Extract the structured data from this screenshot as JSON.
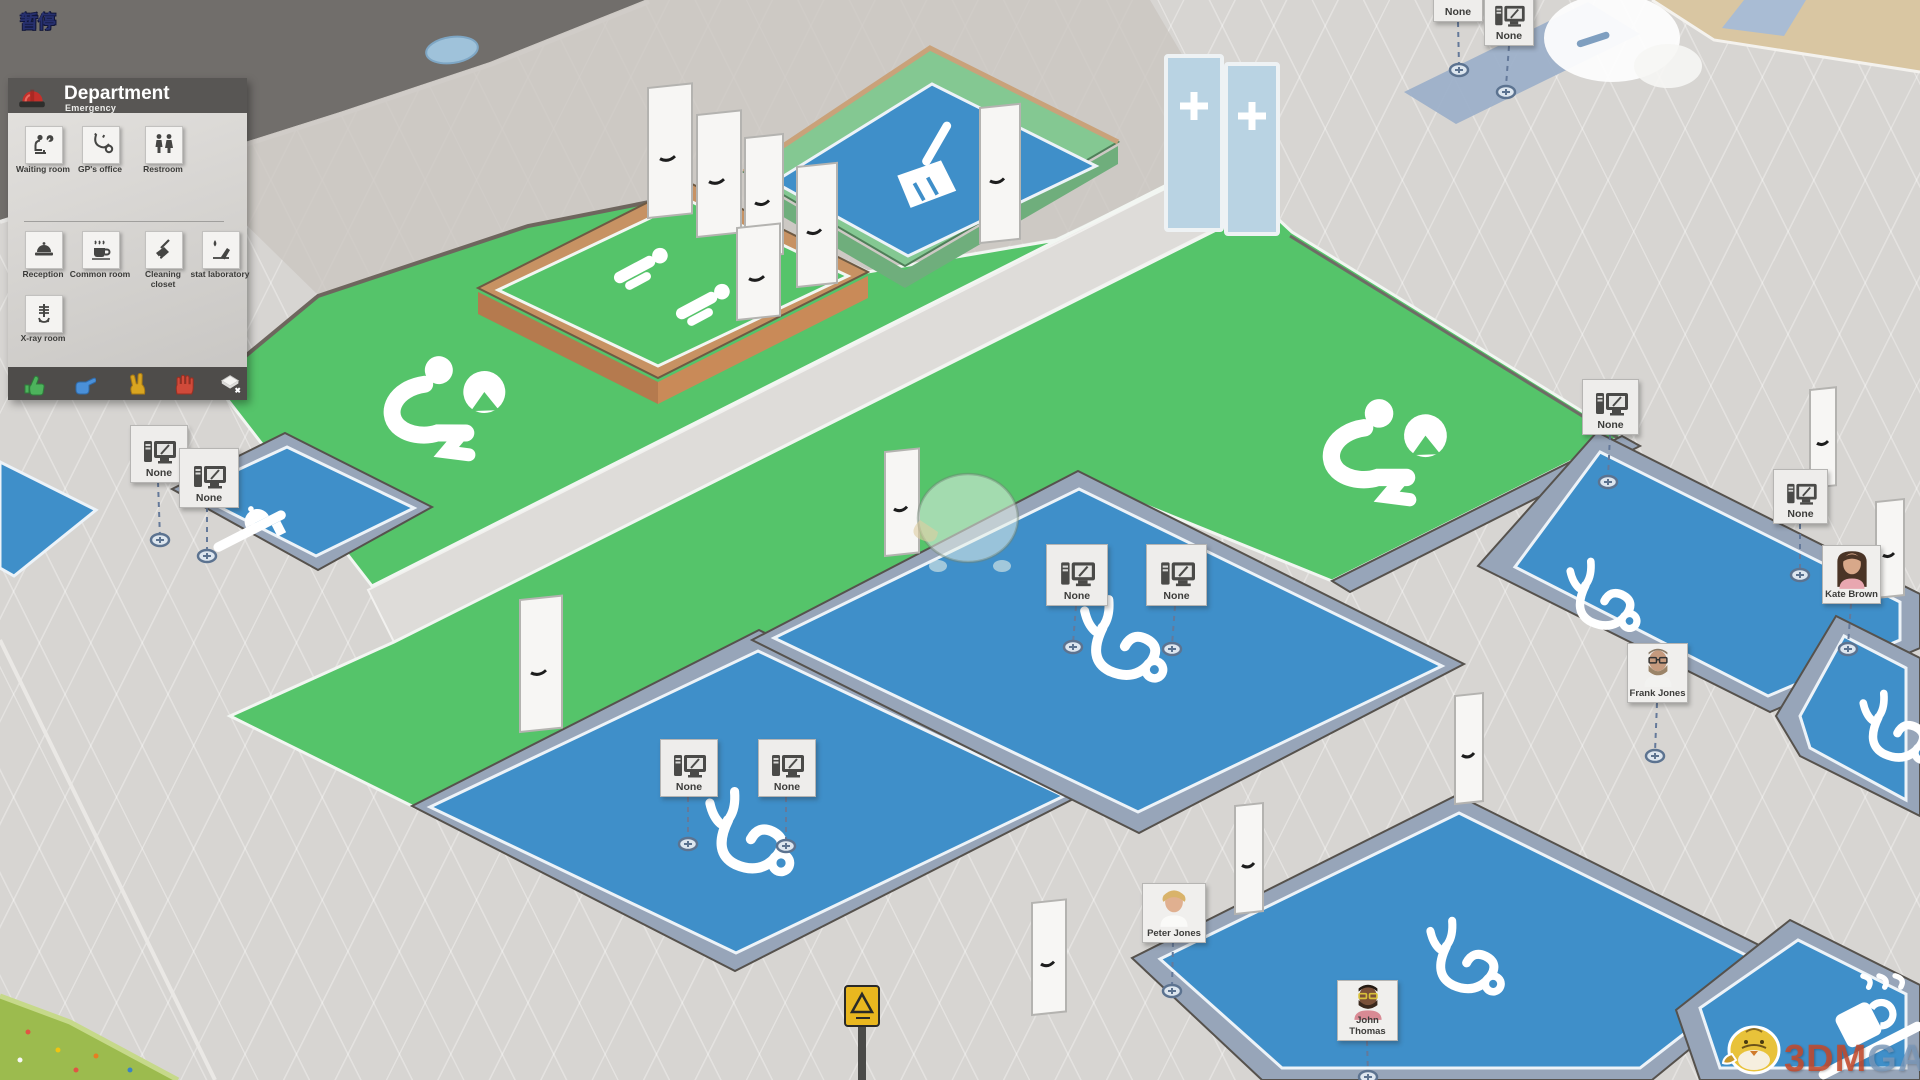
{
  "hud": {
    "pause_label": "暂停"
  },
  "panel": {
    "title": "Department",
    "subtitle": "Emergency",
    "items": [
      {
        "label": "Waiting room",
        "icon": "seated-person-clock-icon"
      },
      {
        "label": "GP's office",
        "icon": "stethoscope-icon"
      },
      {
        "label": "Restroom",
        "icon": "man-woman-icon"
      },
      {
        "label": "Reception",
        "icon": "desk-bell-icon"
      },
      {
        "label": "Common room",
        "icon": "coffee-cup-icon"
      },
      {
        "label": "Cleaning closet",
        "icon": "broom-icon"
      },
      {
        "label": "stat laboratory",
        "icon": "blood-drop-icon"
      },
      {
        "label": "X-ray room",
        "icon": "xray-skeleton-icon"
      }
    ],
    "priority_toolbar": [
      {
        "icon": "thumbs-up-hand-icon",
        "color": "#4db35c"
      },
      {
        "icon": "pointing-hand-icon",
        "color": "#4a90d9"
      },
      {
        "icon": "two-finger-hand-icon",
        "color": "#d9a520"
      },
      {
        "icon": "stop-hand-icon",
        "color": "#d04a3a"
      },
      {
        "icon": "clear-tile-icon",
        "color": "#f4f3f1"
      }
    ]
  },
  "signs": [
    {
      "label": "None"
    },
    {
      "label": "None"
    },
    {
      "label": "None"
    },
    {
      "label": "None"
    },
    {
      "label": "None"
    },
    {
      "label": "None"
    },
    {
      "label": "None"
    },
    {
      "label": "None"
    },
    {
      "label": "None"
    },
    {
      "label": "None"
    }
  ],
  "people": [
    {
      "name": "Kate Brown"
    },
    {
      "name": "Frank Jones"
    },
    {
      "name": "Peter Jones"
    },
    {
      "name": "John Thomas"
    }
  ],
  "watermark": {
    "brand_left": "3DM",
    "brand_right": "GAME"
  },
  "colors": {
    "floor_blue": "#3f8fc9",
    "floor_green": "#55c46a",
    "wall_cap": "#97a5b9",
    "wall_tan": "#c79263",
    "road": "#716e6b",
    "panel_header": "#585654"
  }
}
